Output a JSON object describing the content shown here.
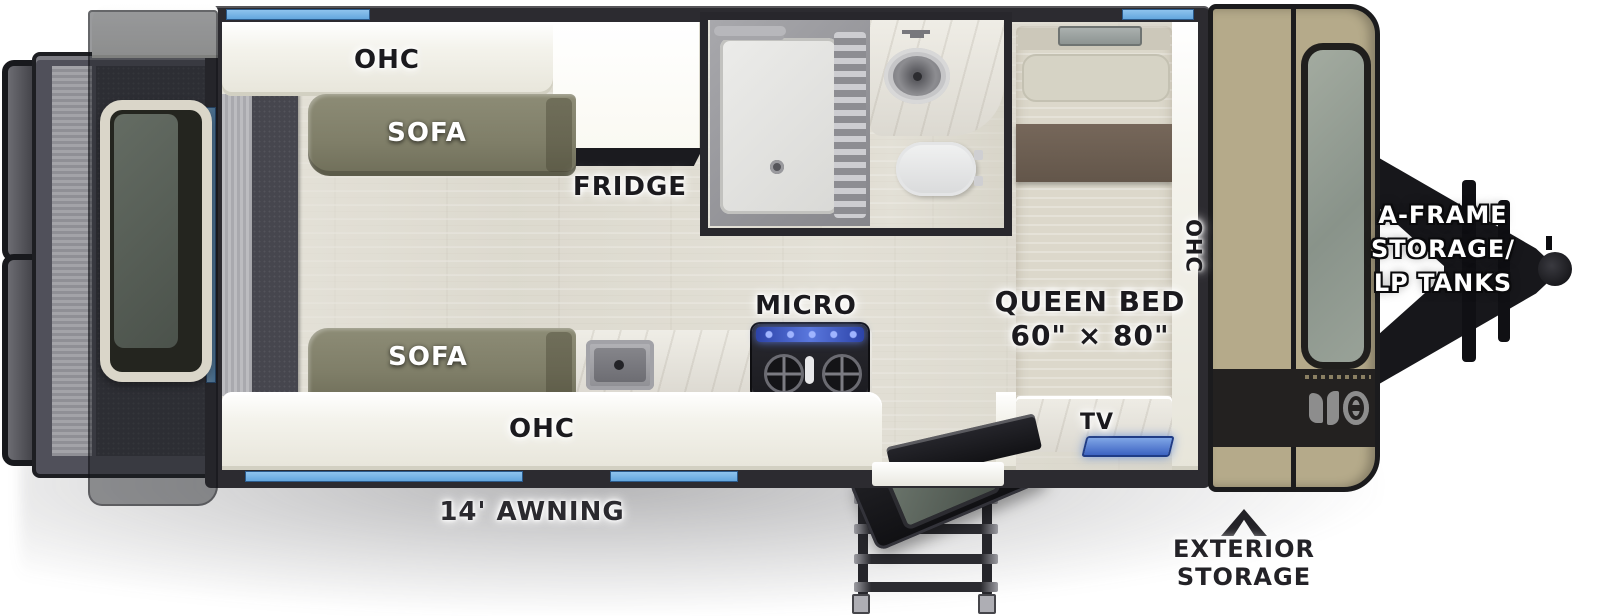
{
  "title": "Travel trailer floor plan",
  "labels": {
    "ohc_top": "OHC",
    "sofa_top": "SOFA",
    "fridge": "FRIDGE",
    "micro": "MICRO",
    "queen_bed_line1": "QUEEN BED",
    "queen_bed_line2": "60\" × 80\"",
    "ohc_front": "OHC",
    "sofa_bottom": "SOFA",
    "ohc_bottom": "OHC",
    "tv": "TV",
    "awning": "14' AWNING",
    "exterior_storage_line1": "EXTERIOR",
    "exterior_storage_line2": "STORAGE",
    "a_frame_line1": "A-FRAME",
    "a_frame_line2": "STORAGE/",
    "a_frame_line3": "LP TANKS"
  },
  "colors": {
    "window_blue": "#6fb0e6",
    "front_cap_tan": "#b5aa8a",
    "sofa_olive": "#85846e",
    "wall_black": "#2c2b30",
    "floor_wood": "#e1ded4",
    "stove_led_blue": "#4a63cf",
    "tv_led_blue": "#5e87d8"
  },
  "fixtures": [
    "rear-cargo-doors",
    "rear-window",
    "overhead-cabinets",
    "sofas",
    "refrigerator",
    "shower",
    "bathroom-sink",
    "toilet",
    "queen-bed",
    "tv-cabinet",
    "kitchen-sink",
    "cooktop-microwave",
    "entry-door",
    "entry-steps",
    "front-window",
    "a-frame-tongue",
    "lp-tanks"
  ]
}
